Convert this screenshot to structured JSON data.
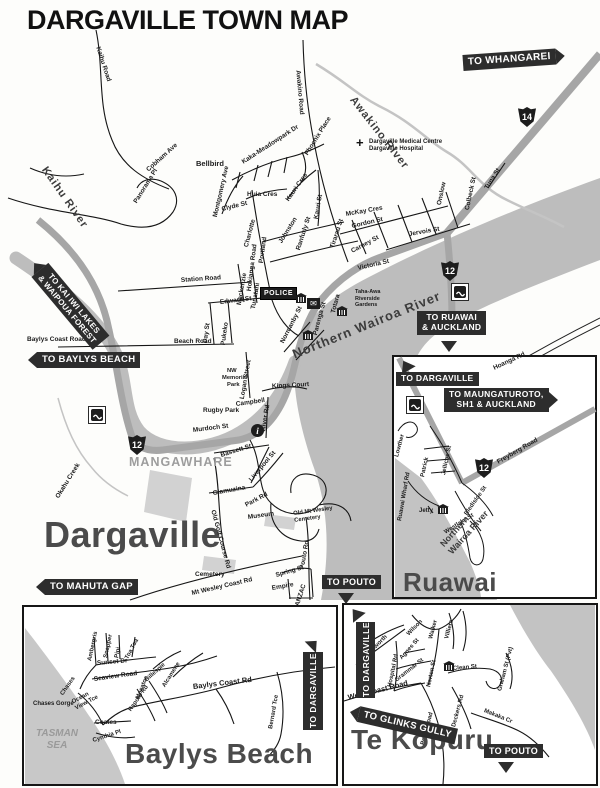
{
  "title": "DARGAVILLE TOWN MAP",
  "colors": {
    "river": "#bdbdbd",
    "highway": "#a6a6a6",
    "sign_bg": "#2d2d2d",
    "ink": "#161616"
  },
  "icons": {
    "info": "i",
    "medical_cross": "+",
    "mail": "✉",
    "sh12": "12",
    "sh14": "14"
  },
  "m": {
    "rivers": {
      "kaihu": "Kaihu  River",
      "awakino": "Awakino River",
      "northern_wairoa": "Northern Wairoa River",
      "okahu": "Okahu Creek"
    },
    "places": {
      "dargaville": "Dargaville",
      "mangawhare": "MANGAWHARE",
      "police": "POLICE",
      "hospital_1": "Dargaville Medical Centre",
      "hospital_2": "Dargaville Hospital",
      "taha_1": "Taha-Awa",
      "taha_2": "Riverside",
      "taha_3": "Gardens",
      "rugby": "Rugby Park",
      "campbell": "Campbell",
      "nw_1": "NW",
      "nw_2": "Memorial",
      "nw_3": "Park",
      "museum": "Museum",
      "old_cem_1": "Old Mt Wesley",
      "old_cem_2": "Cemetery",
      "cemetery": "Cemetery",
      "empire": "Empire",
      "kings_court": "Kings Court"
    },
    "signs": {
      "whangarei": "TO WHANGAREI",
      "kai_iwi_1": "TO KAI IWI LAKES",
      "kai_iwi_2": "& WAIPOUA FOREST",
      "baylys": "TO BAYLYS BEACH",
      "ruawai_1": "TO RUAWAI",
      "ruawai_2": "& AUCKLAND",
      "mahuta": "TO MAHUTA GAP",
      "pouto": "TO POUTO"
    },
    "streets": {
      "kaihu_road": "Kaihu Road",
      "cobham": "Cobham Ave",
      "panorama": "Panorama Pl",
      "bellbird": "Bellbird",
      "meadowpark": "Kaka-Meadowpark Dr",
      "phoenix": "Phoenix Place",
      "montgomery": "Montgomery Ave",
      "huia": "Huia Cres",
      "kauri_cres": "Kauri Cres",
      "kauri_st": "Kauri St",
      "awakino_rd": "Awakino Road",
      "clyde": "Clyde St",
      "charlotte": "Charlotte",
      "portland": "Portland",
      "johnston": "Johnston",
      "ranfurly": "Ranfurly St",
      "tirarau": "Tirarau St",
      "carney": "Carney St",
      "gordon": "Gordon St",
      "mckay": "McKay Cres",
      "onslow": "Onslow",
      "colbeck": "Colbeck St",
      "jervois": "Jervois St",
      "victoria": "Victoria St",
      "hokianga": "Hokianga Road",
      "station": "Station Road",
      "edward": "Edward St",
      "day": "Day St",
      "pukeko": "Pukeko",
      "mackenzie": "Mackenzie",
      "tunatahi": "Tunatahi",
      "normanby": "Normanby St",
      "parenga": "Parenga St",
      "totara": "Totara",
      "beach": "Beach Road",
      "baylys_coast": "Baylys Coast Road",
      "murdoch": "Murdoch St",
      "bassett": "Bassett St",
      "liverpool": "Liverpool St",
      "glamuzina": "Glamuzina",
      "logan": "Logan Street",
      "river_rd": "River Rd",
      "park_rd": "Park Rd",
      "old_golf": "Old Golf Course Rd",
      "pouto_rd": "Pouto Rd",
      "spring": "Spring St",
      "anzac": "ANZAC",
      "mt_wesley": "Mt Wesley Coast Rd",
      "hoanga": "Hoanga Rd",
      "tuna": "Tuna St"
    }
  },
  "ruawai": {
    "title": "Ruawai",
    "signs": {
      "dargaville": "TO DARGAVILLE",
      "maunga_1": "TO MAUNGATUROTO,",
      "maunga_2": "SH1 & AUCKLAND"
    },
    "streets": {
      "freyberg": "Freyberg Road",
      "lowther": "Lowther",
      "patrick": "Patrick",
      "jellicoe": "Jellicoe St",
      "bledisloe": "Bledisloe St",
      "westlake": "Westlake St",
      "wharf": "Ruawai Wharf Rd",
      "jetty": "Jetty"
    },
    "river_1": "Northern",
    "river_2": "Wairoa River"
  },
  "baylys": {
    "title": "Baylys Beach",
    "sign_dargaville": "TO DARGAVILLE",
    "sea_1": "TASMAN",
    "sea_2": "SEA",
    "gorge": "Chases Gorge",
    "streets": {
      "ambergris": "Ambergris",
      "snapper": "Snapper",
      "pipi": "Pipi",
      "toa_toa": "Toa Toa",
      "sunset": "Sunset Dr",
      "seaview": "Seaview Road",
      "chases": "Chases",
      "gillespie": "Gillespie",
      "alcamene": "Alcamene",
      "moeatoa": "Moeatoa",
      "rapoto": "Rapoto Rd",
      "ocean_1": "Ocean",
      "ocean_2": "View Tce",
      "coates": "Coates",
      "cynthia": "Cynthia Pl",
      "baylys_coast": "Baylys Coast Rd",
      "bernard": "Bernard Tce"
    }
  },
  "tekopuru": {
    "title": "Te Kopuru",
    "signs": {
      "dargaville": "TO DARGAVILLE",
      "glinks": "TO GLINKS GULLY",
      "pouto": "TO POUTO"
    },
    "streets": {
      "wilson": "Wilson",
      "walker": "Walker",
      "villiers": "Villiers",
      "wordsworth": "Wordsworth",
      "hospital_rd": "Hospital Rd",
      "agnes": "Agnes St",
      "grammar": "Grammar St",
      "norton": "Norton St",
      "clean": "Clean St",
      "graham": "Graham St (Pvt)",
      "deckers": "Deckers Rd",
      "makaka": "Makaka Cr",
      "west_coast": "West Coast Road",
      "pouto_road": "Pouto Road"
    }
  }
}
